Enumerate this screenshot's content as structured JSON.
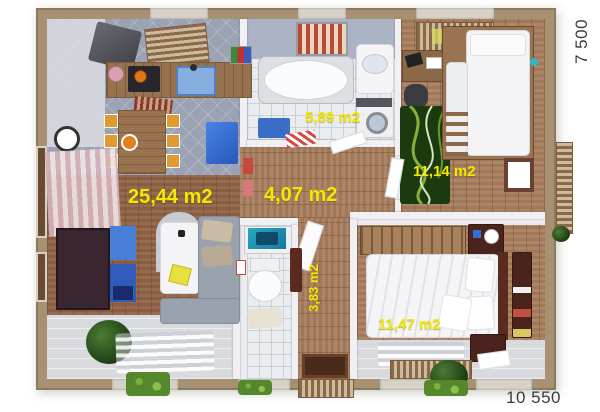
{
  "floorplan": {
    "rooms": [
      {
        "name": "living-room-kitchen",
        "area_label": "25,44 m2"
      },
      {
        "name": "hallway",
        "area_label": "4,07 m2"
      },
      {
        "name": "bathroom",
        "area_label": "5,89 m2"
      },
      {
        "name": "kids-room",
        "area_label": "11,14 m2"
      },
      {
        "name": "wc-entry",
        "area_label": "3,83 m2"
      },
      {
        "name": "bedroom",
        "area_label": "11,47 m2"
      }
    ],
    "dimensions": {
      "side_right": "7 500",
      "side_bottom": "10 550"
    },
    "colors": {
      "area_label_yellow": "#F2EA00",
      "dimension_text": "#3C3C3C",
      "exterior_wall_tan": "#A79172",
      "interior_wall_white": "#F0F0F3",
      "wood_floor": "#A87E5E",
      "kitchen_tile_gray": "#9AA2B4",
      "wc_tile_white": "#EAEDF0",
      "kids_rug_green": "#1C3A10",
      "accent_blue": "#3E6FD0"
    }
  }
}
